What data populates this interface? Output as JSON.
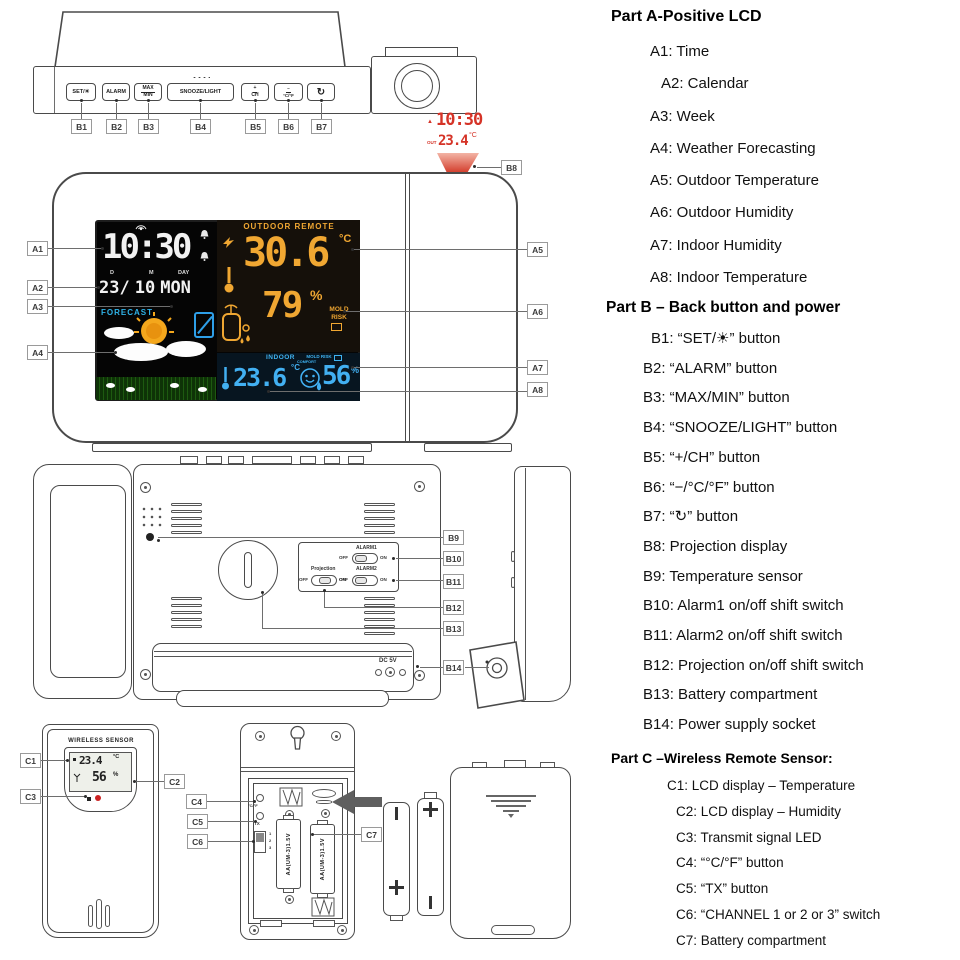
{
  "colors": {
    "lcd_amber": "#f0a732",
    "lcd_blue": "#42b0f2",
    "lcd_cyan": "#2fb3e8",
    "projection_red": "#d53327",
    "led_red": "#cc2222"
  },
  "legend": {
    "part_a": {
      "title": "Part A-Positive LCD",
      "items": [
        "A1: Time",
        "A2: Calendar",
        "A3: Week",
        "A4: Weather Forecasting",
        "A5: Outdoor Temperature",
        "A6: Outdoor Humidity",
        "A7: Indoor Humidity",
        "A8: Indoor Temperature"
      ]
    },
    "part_b": {
      "title": "Part B – Back button and power",
      "items": [
        "B1: “SET/☀” button",
        "B2: “ALARM” button",
        "B3: “MAX/MIN” button",
        "B4: “SNOOZE/LIGHT” button",
        "B5: “+/CH” button",
        "B6: “−/°C/°F” button",
        "B7: “↻” button",
        "B8: Projection display",
        "B9: Temperature sensor",
        "B10: Alarm1 on/off shift switch",
        "B11: Alarm2 on/off shift switch",
        "B12: Projection on/off shift switch",
        "B13: Battery compartment",
        "B14: Power supply socket"
      ]
    },
    "part_c": {
      "title": "Part C –Wireless Remote Sensor:",
      "items": [
        "C1: LCD display – Temperature",
        "C2: LCD display – Humidity",
        "C3: Transmit signal LED",
        "C4: “°C/°F” button",
        "C5: “TX” button",
        "C6: “CHANNEL 1 or 2 or 3” switch",
        "C7: Battery compartment"
      ]
    }
  },
  "top_view": {
    "buttons": [
      {
        "label": "SET/☀"
      },
      {
        "label": "ALARM"
      },
      {
        "top": "MAX",
        "bottom": "MIN"
      },
      {
        "label": "SNOOZE/LIGHT"
      },
      {
        "top": "+",
        "bottom": "CH"
      },
      {
        "top": "−",
        "bottom": "°C/°F"
      },
      {
        "label": "↻"
      }
    ],
    "callouts": [
      "B1",
      "B2",
      "B3",
      "B4",
      "B5",
      "B6",
      "B7"
    ]
  },
  "projection": {
    "alarm_marker": "▲",
    "time": "10:30",
    "out_label": "OUT",
    "temp": "23.4",
    "temp_unit": "°C",
    "callout": "B8"
  },
  "front_view": {
    "lcd": {
      "time": "10:30",
      "date": {
        "d_label": "D",
        "m_label": "M",
        "day_label": "DAY",
        "day": "23/",
        "month": "10",
        "weekday": "MON"
      },
      "forecast_label": "FORECAST",
      "outdoor": {
        "header": "OUTDOOR REMOTE",
        "temp": "30.6",
        "temp_unit": "°C",
        "humidity": "79",
        "humidity_unit": "%",
        "mold_label": "MOLD RISK"
      },
      "indoor": {
        "header": "INDOOR",
        "mold_label": "MOLD RISK",
        "temp": "23.6",
        "temp_unit": "°C",
        "comfort_label": "COMFORT",
        "humidity": "56",
        "humidity_unit": "%"
      }
    },
    "callouts_left": [
      "A1",
      "A2",
      "A3",
      "A4"
    ],
    "callouts_right": [
      "A5",
      "A6",
      "A7",
      "A8"
    ]
  },
  "back_view": {
    "switch_panel": {
      "alarm1_label": "ALARM1",
      "alarm2_label": "ALARM2",
      "projection_label": "Projection",
      "off": "OFF",
      "on": "ON"
    },
    "power_label": "DC 5V",
    "callouts": [
      "B9",
      "B10",
      "B11",
      "B12",
      "B13",
      "B14"
    ]
  },
  "sensor": {
    "front": {
      "title": "WIRELESS SENSOR",
      "temp": "23.4",
      "temp_unit": "°C",
      "humidity": "56",
      "humidity_unit": "%",
      "callouts": [
        "C1",
        "C2",
        "C3"
      ]
    },
    "back": {
      "cf_label": "°C/°F",
      "tx_label": "TX",
      "channels": [
        "1",
        "2",
        "3"
      ],
      "battery_text": "AA(UM-3)1.5V",
      "callouts": [
        "C4",
        "C5",
        "C6",
        "C7"
      ]
    },
    "batteries": {
      "plus": "+",
      "minus": "−"
    }
  }
}
